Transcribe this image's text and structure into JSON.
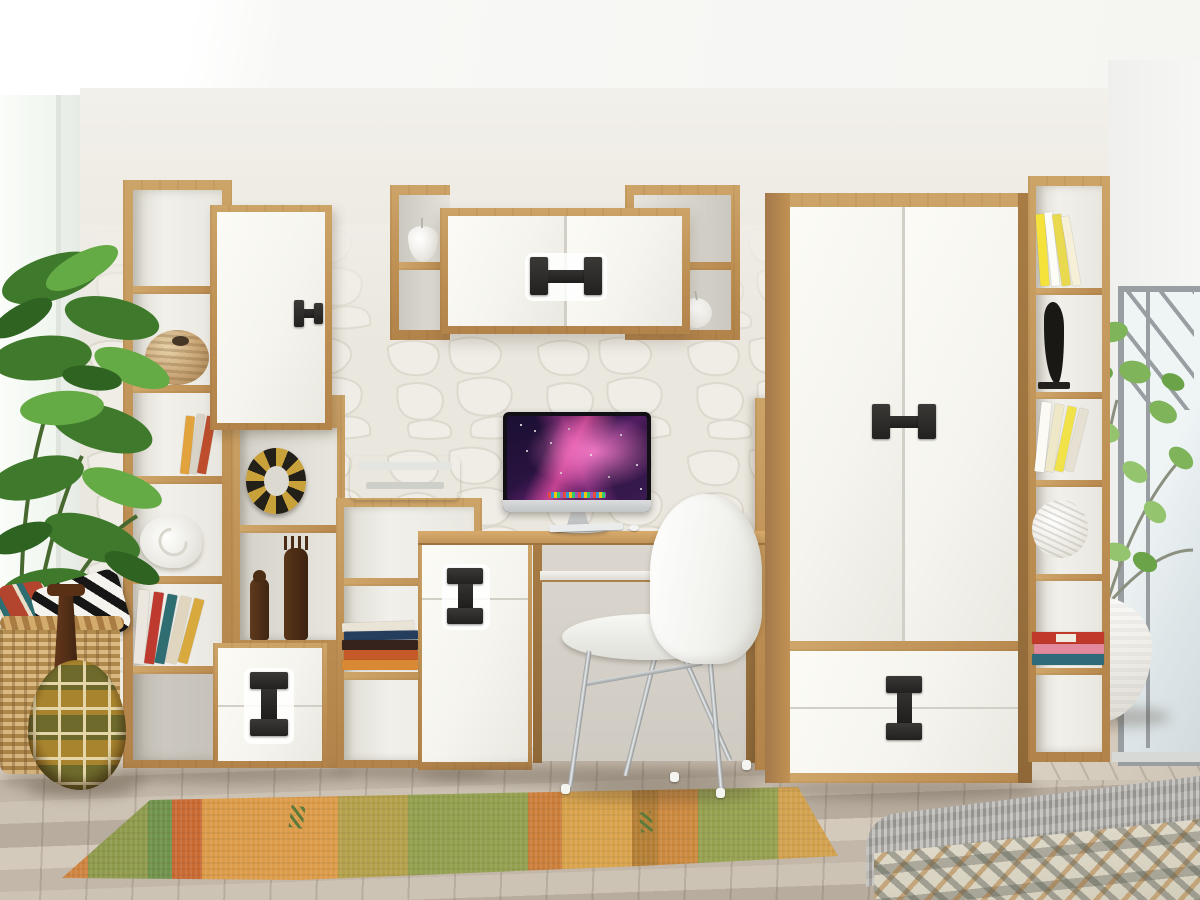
{
  "scene": {
    "title": "Children's room furniture wall unit in oak and white",
    "setting": "Bright interior, white 3D stone accent wall, grey-washed wood plank floor, windows on both sides",
    "visible_text": "none"
  },
  "palette": {
    "oak": "#c09154",
    "oak_dark": "#8f6838",
    "door_white": "#f7f6f1",
    "handle_black": "#2b2927",
    "stone_wall": "#eae7df",
    "left_wall": "#eef1ec",
    "ceiling": "#fbfbf9",
    "floor": "#c8bdb0",
    "rug_orange": "#d79243",
    "rug_green": "#8f9c4d",
    "plant_green": "#55903a",
    "chrome": "#c0c4c6",
    "screen_magenta": "#c2459a",
    "screen_dark": "#1b0f33"
  },
  "objects": {
    "left_plant": {
      "label": "tall monstera plant in front of left window"
    },
    "left_bookcase": {
      "label": "tall oak open shelving with decor items"
    },
    "upper_door_cabinet": {
      "label": "white one-door wall cabinet with black pull"
    },
    "lower_drawer_cabinet": {
      "label": "white two-drawer cabinet with black dumbbell pull"
    },
    "wall_shelf": {
      "label": "wall-mounted oak shelf with double white doors, ceramic pear and apple"
    },
    "printer": {
      "label": "white printer on low oak shelf"
    },
    "desk_cabinet": {
      "label": "white desk pedestal cabinet with black dumbbell pull"
    },
    "desk": {
      "label": "oak computer desk"
    },
    "imac": {
      "label": "all-in-one computer with purple galaxy wallpaper, keyboard and mouse"
    },
    "chair": {
      "label": "white shell chair with chrome legs"
    },
    "wardrobe": {
      "label": "oak wardrobe with two white doors and two drawers, black dumbbell pulls"
    },
    "right_bookcase": {
      "label": "narrow oak bookcase with books, sculpture and woven ball"
    },
    "right_window": {
      "label": "grey metal frame window"
    },
    "potted_plant": {
      "label": "green plant in round white pot"
    },
    "rug": {
      "label": "orange and green kilim runner rug"
    },
    "basket": {
      "label": "wicker basket with patterned pillows"
    },
    "floor_vase": {
      "label": "brown gourd vase with cream lattice pattern"
    },
    "bed": {
      "label": "bed corner with grey knit blanket and ikat duvet"
    },
    "decor_items": [
      "woven ball vase",
      "nautilus shell",
      "tribal ring ornament",
      "carved wooden figurines",
      "leaning books",
      "yellow books",
      "red and pink books",
      "black abstract sculpture",
      "white ceramic pear",
      "white ceramic apple",
      "white woven ball"
    ]
  },
  "handles": {
    "style": "black dumbbell pulls",
    "count": 6
  }
}
